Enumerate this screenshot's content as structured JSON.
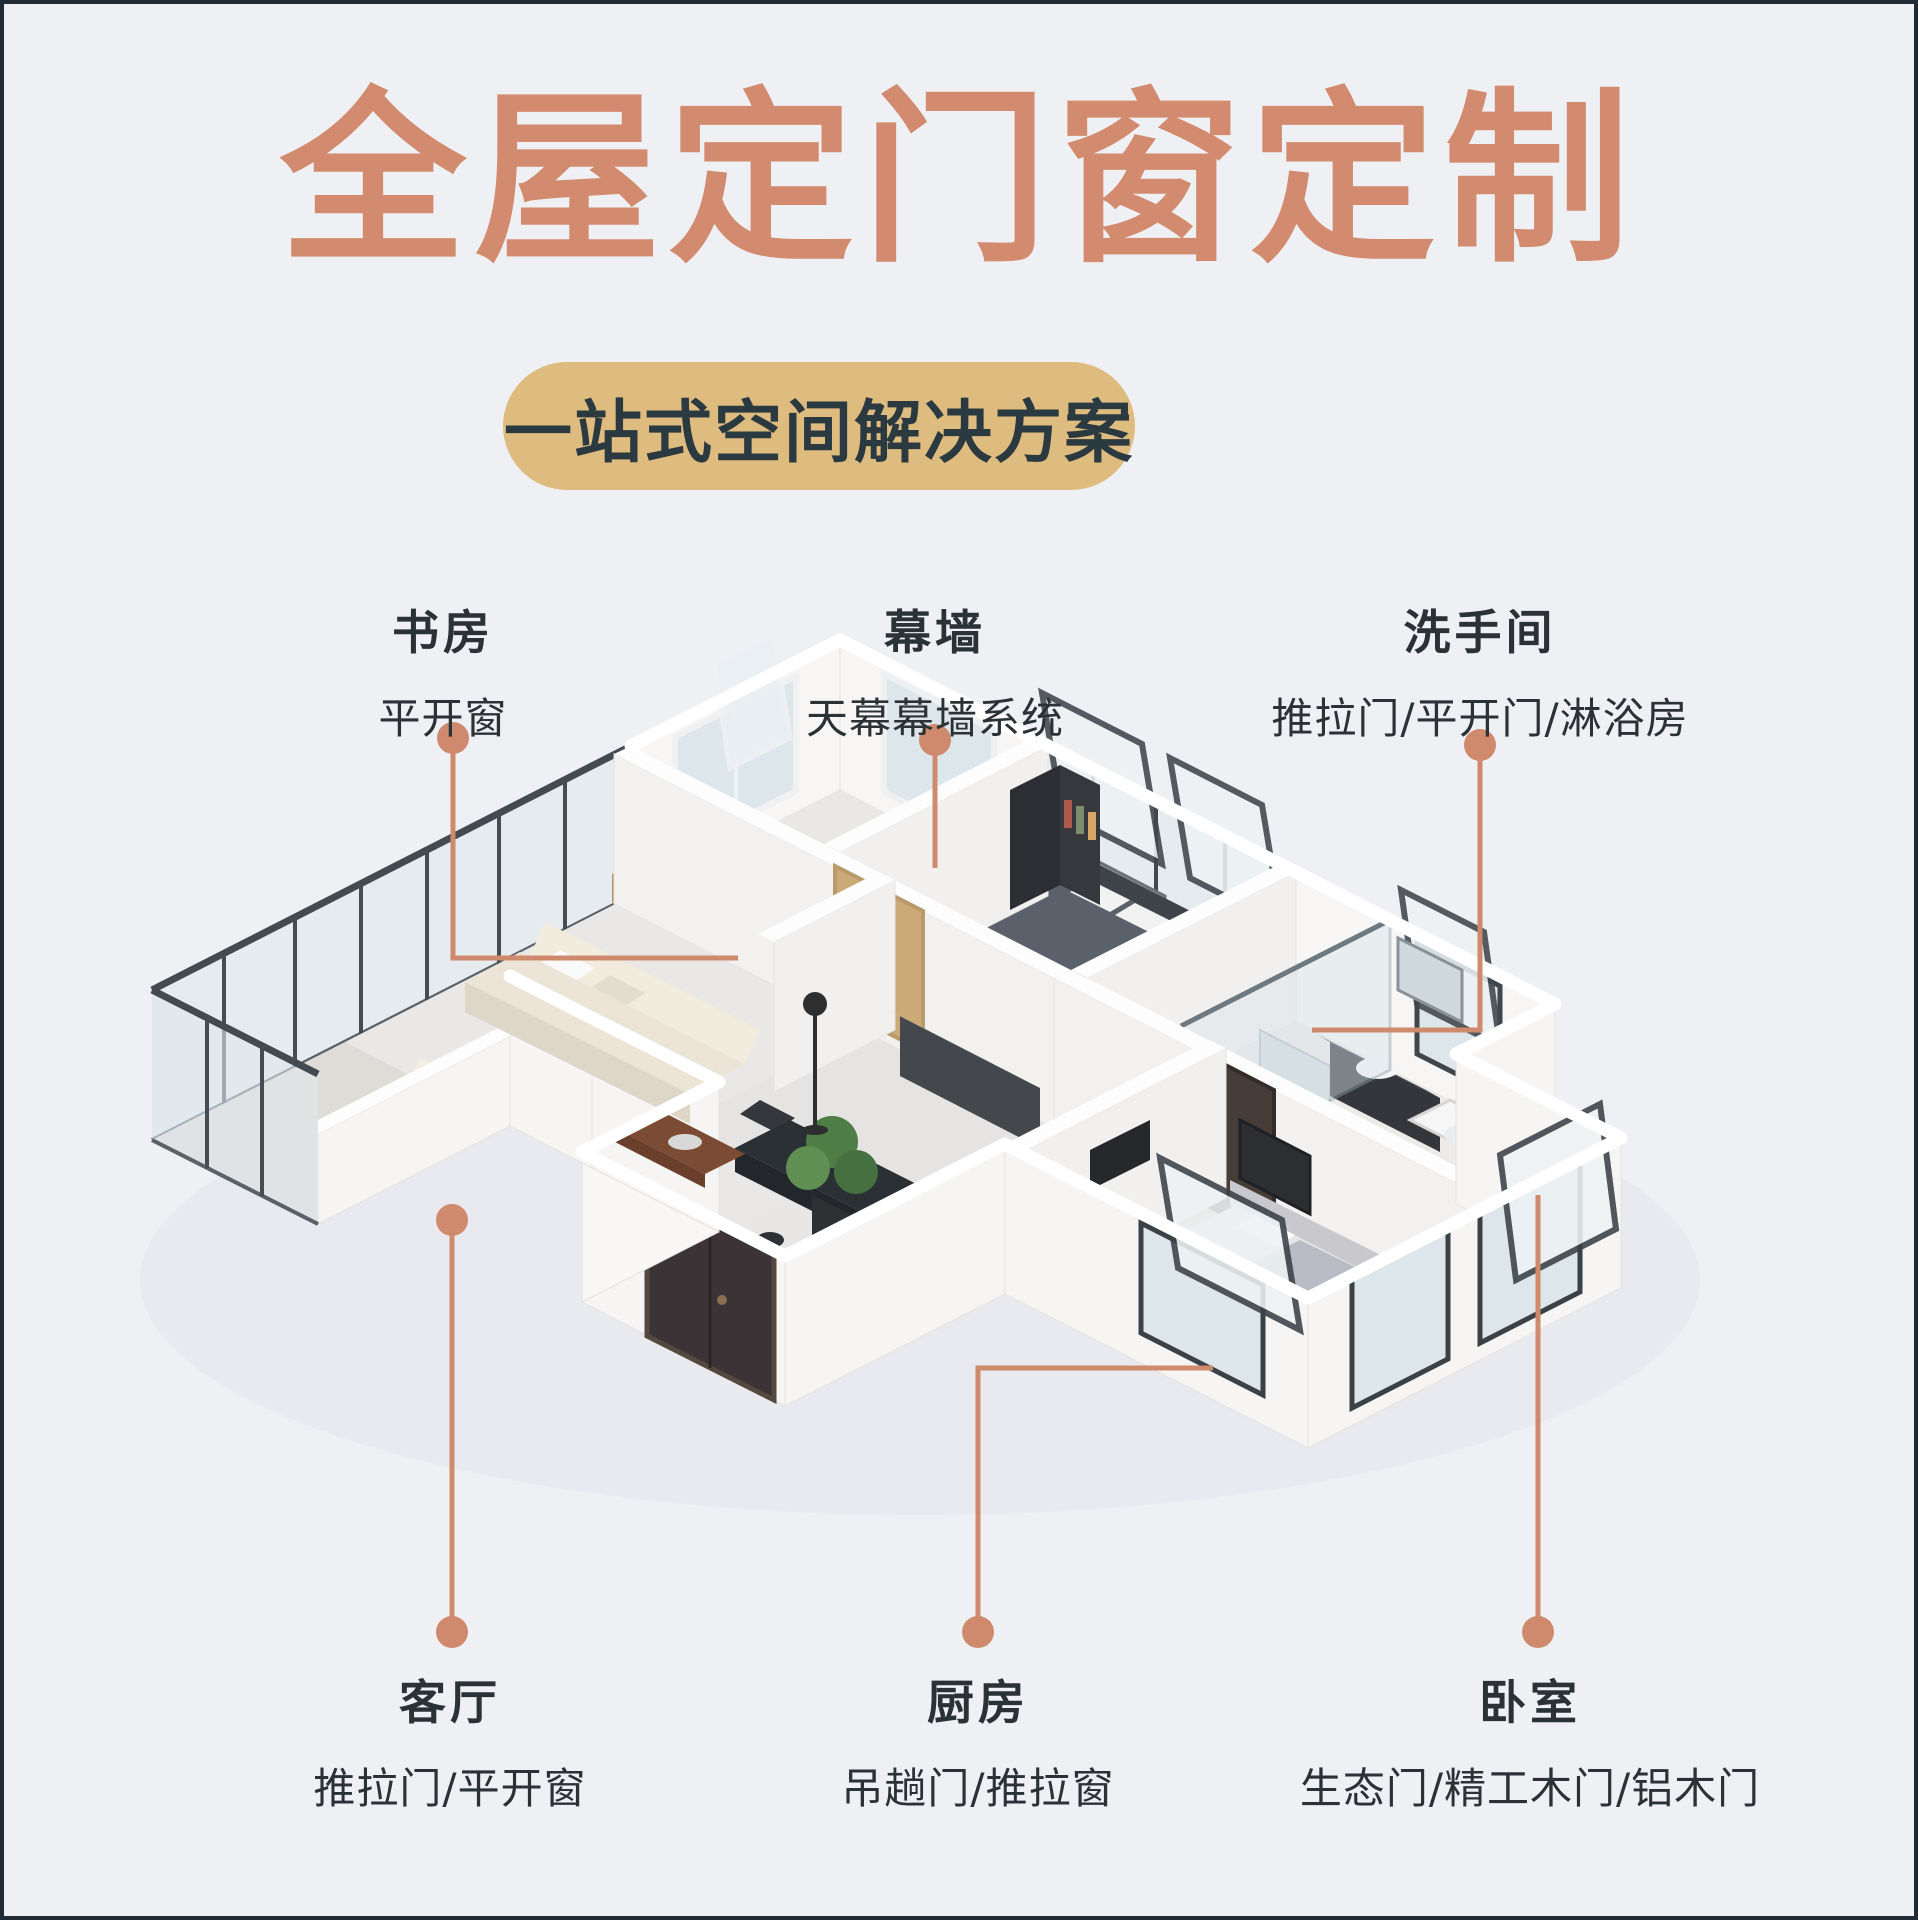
{
  "header": {
    "title": "全屋定门窗定制",
    "subtitle": "一站式空间解决方案"
  },
  "callouts": [
    {
      "room": "书房",
      "products": "平开窗",
      "position": "top-left"
    },
    {
      "room": "幕墙",
      "products": "天幕幕墙系统",
      "position": "top-center"
    },
    {
      "room": "洗手间",
      "products": "推拉门/平开门/淋浴房",
      "position": "top-right"
    },
    {
      "room": "客厅",
      "products": "推拉门/平开窗",
      "position": "bottom-left"
    },
    {
      "room": "厨房",
      "products": "吊趟门/推拉窗",
      "position": "bottom-center"
    },
    {
      "room": "卧室",
      "products": "生态门/精工木门/铝木门",
      "position": "bottom-right"
    }
  ],
  "illustration_description": "isometric 3D floor plan render of an apartment with white walls, dark aluminium framed windows and doors",
  "colors": {
    "background": "#eff0f4",
    "title_text": "#d28b6e",
    "pill_background": "#debb7e",
    "pill_text": "#2b3a40",
    "label_text": "#2b3236",
    "leader_line": "#cf8a6d"
  }
}
